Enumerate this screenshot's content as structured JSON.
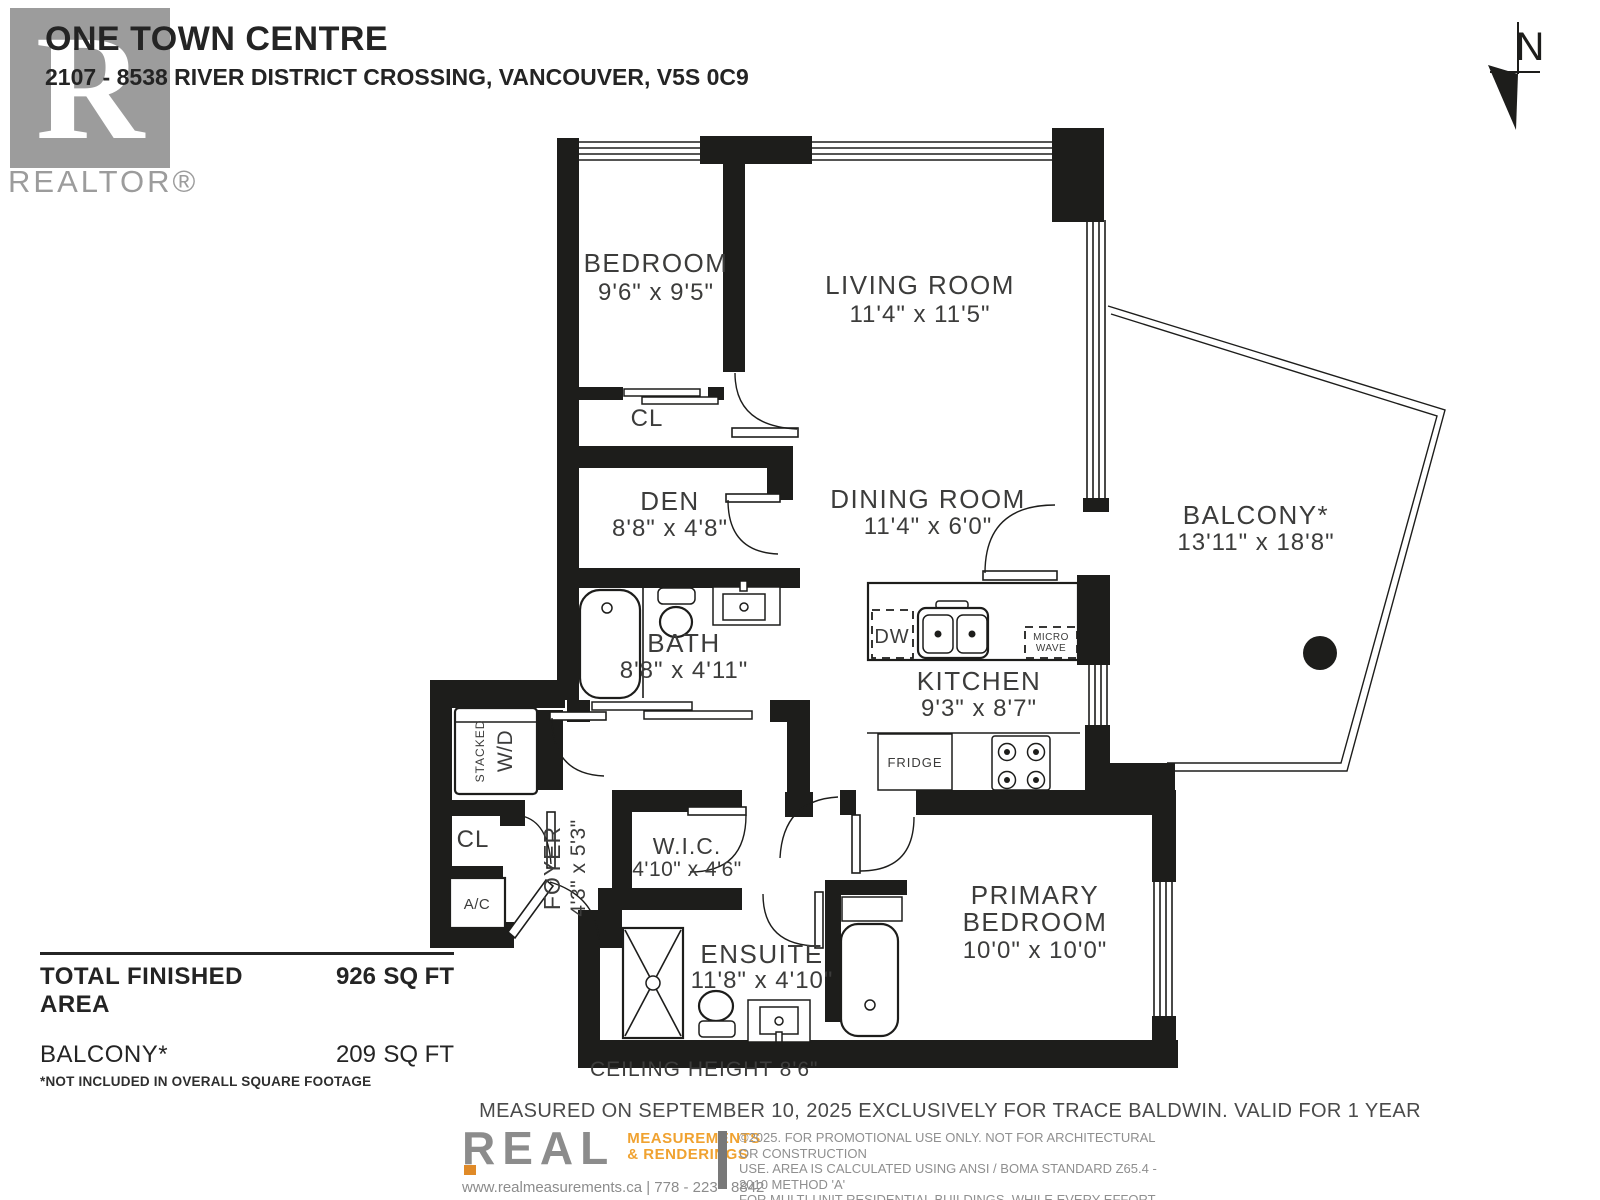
{
  "header": {
    "title": "ONE TOWN CENTRE",
    "address": "2107 - 8538 RIVER DISTRICT CROSSING, VANCOUVER, V5S 0C9",
    "realtor_logo_letter": "R",
    "realtor_logo_text": "REALTOR®",
    "north_label": "N"
  },
  "rooms": {
    "bedroom": {
      "name": "BEDROOM",
      "dims": "9'6\" x 9'5\""
    },
    "living": {
      "name": "LIVING ROOM",
      "dims": "11'4\" x 11'5\""
    },
    "den": {
      "name": "DEN",
      "dims": "8'8\" x 4'8\""
    },
    "dining": {
      "name": "DINING ROOM",
      "dims": "11'4\" x 6'0\""
    },
    "bath": {
      "name": "BATH",
      "dims": "8'8\" x 4'11\""
    },
    "kitchen": {
      "name": "KITCHEN",
      "dims": "9'3\" x 8'7\""
    },
    "balcony": {
      "name": "BALCONY*",
      "dims": "13'11\" x 18'8\""
    },
    "foyer": {
      "name": "FOYER",
      "dims": "4'3\" x 5'3\""
    },
    "wic": {
      "name": "W.I.C.",
      "dims": "4'10\" x 4'6\""
    },
    "ensuite": {
      "name": "ENSUITE",
      "dims": "11'8\" x 4'10\""
    },
    "primary": {
      "name1": "PRIMARY",
      "name2": "BEDROOM",
      "dims": "10'0\" x 10'0\""
    },
    "closet_bedroom": "CL",
    "closet_foyer": "CL"
  },
  "fixtures": {
    "dw": "DW",
    "microwave_line1": "MICRO",
    "microwave_line2": "WAVE",
    "fridge": "FRIDGE",
    "stacked": "STACKED",
    "wd": "W/D",
    "ac": "A/C"
  },
  "areas": {
    "total_label": "TOTAL FINISHED AREA",
    "total_value": "926",
    "total_unit": "SQ FT",
    "balcony_label": "BALCONY*",
    "balcony_value": "209",
    "balcony_unit": "SQ FT",
    "footnote": "*NOT INCLUDED IN OVERALL SQUARE FOOTAGE"
  },
  "notes": {
    "ceiling": "CEILING HEIGHT 8'6\"",
    "measured": "MEASURED ON SEPTEMBER 10, 2025 EXCLUSIVELY FOR TRACE BALDWIN. VALID FOR 1 YEAR"
  },
  "footer": {
    "brand": "REAL",
    "brand_sub1": "MEASUREMENTS",
    "brand_sub2": "& RENDERINGS",
    "contact": "www.realmeasurements.ca | 778 - 223 - 8842",
    "disclaimer_lines": [
      "©2025. FOR PROMOTIONAL USE ONLY. NOT FOR ARCHITECTURAL OR CONSTRUCTION",
      "USE. AREA IS CALCULATED USING ANSI / BOMA STANDARD Z65.4 - 2010 METHOD 'A'",
      "FOR MULTI-UNIT RESIDENTIAL BUILDINGS. WHILE EVERY EFFORT IS MADE TO ENSURE",
      "THE ACCURACY, DIMENSIONS AND TOTAL AREA ARE NOT GUARANTEED. E&OE"
    ]
  },
  "colors": {
    "wall": "#1d1d1b",
    "accent_orange": "#f0a230",
    "logo_gray": "#9c9c9c"
  }
}
